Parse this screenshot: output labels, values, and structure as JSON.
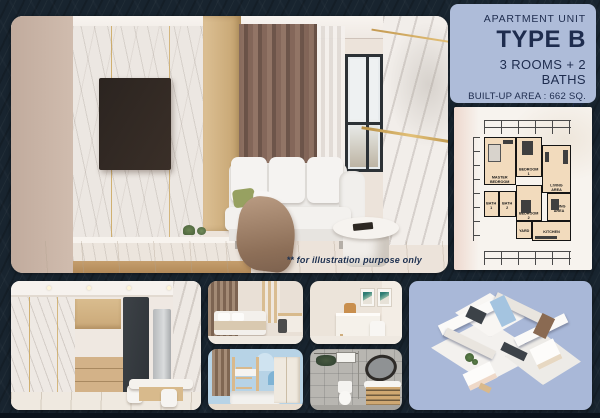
{
  "poster": {
    "panel": {
      "subtitle": "APARTMENT UNIT",
      "title": "TYPE B",
      "rooms": "3 ROOMS + 2 BATHS",
      "area": "BUILT-UP AREA : 662 SQ. FT."
    },
    "caption": "** for illustration purpose only",
    "floorplan": {
      "master": "MASTER BEDROOM",
      "bedroom1": "BEDROOM 1",
      "bedroom2": "BEDROOM 2",
      "living": "LIVING AREA",
      "dining": "DINING AREA",
      "kitchen": "KITCHEN",
      "yard": "YARD",
      "bath1": "BATH 1",
      "bath2": "BATH 2"
    },
    "colors": {
      "background": "#18242f",
      "panel_bg": "#aebcd9",
      "navy_text": "#1e2c4e",
      "plan_paper": "#f7f3ee",
      "plan_room_fill": "#f2dbbd",
      "iso_bg": "#a9b8d8",
      "gold_accent": "#c9a254"
    }
  }
}
